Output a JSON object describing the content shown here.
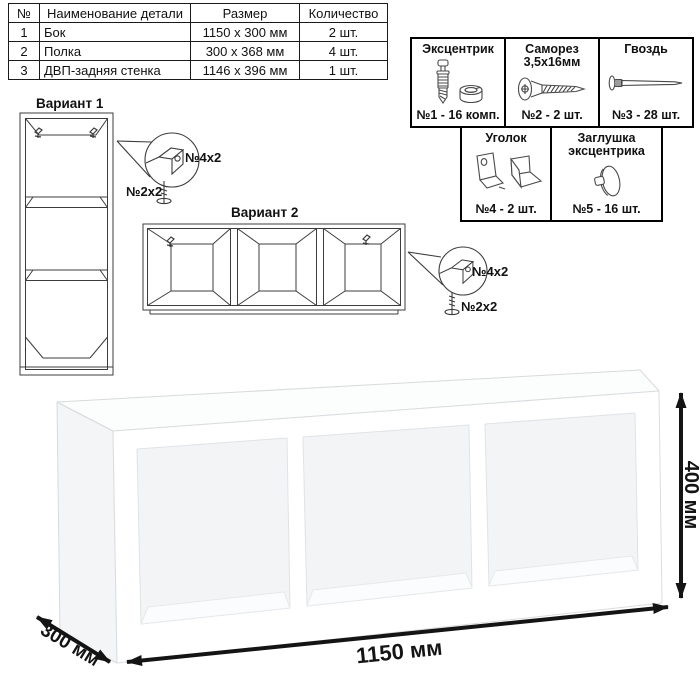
{
  "parts_table": {
    "headers": {
      "num": "№",
      "name": "Наименование детали",
      "size": "Размер",
      "qty": "Количество"
    },
    "rows": [
      {
        "num": "1",
        "name": "Бок",
        "size": "1150 x 300 мм",
        "qty": "2 шт."
      },
      {
        "num": "2",
        "name": "Полка",
        "size": "300 x 368 мм",
        "qty": "4 шт."
      },
      {
        "num": "3",
        "name": "ДВП-задняя стенка",
        "size": "1146 x 396 мм",
        "qty": "1 шт."
      }
    ]
  },
  "hardware_box": {
    "items": [
      {
        "title": "Эксцентрик",
        "qty": "№1 - 16 комп."
      },
      {
        "title": "Саморез 3,5х16мм",
        "qty": "№2 - 2 шт."
      },
      {
        "title": "Гвоздь",
        "qty": "№3 - 28 шт."
      },
      {
        "title": "Уголок",
        "qty": "№4 - 2 шт."
      },
      {
        "title": "Заглушка эксцентрика",
        "qty": "№5 - 16 шт."
      }
    ]
  },
  "variants": {
    "v1": {
      "title": "Вариант 1",
      "bracket_label": "№4х2",
      "screw_label": "№2х2"
    },
    "v2": {
      "title": "Вариант 2",
      "bracket_label": "№4х2",
      "screw_label": "№2х2"
    }
  },
  "dimensions": {
    "width": "1150 мм",
    "height": "400 мм",
    "depth": "300 мм"
  },
  "colors": {
    "line_art": "#3c3c3c",
    "text": "#111111",
    "border": "#000000",
    "render_outline": "#d7dadc"
  }
}
